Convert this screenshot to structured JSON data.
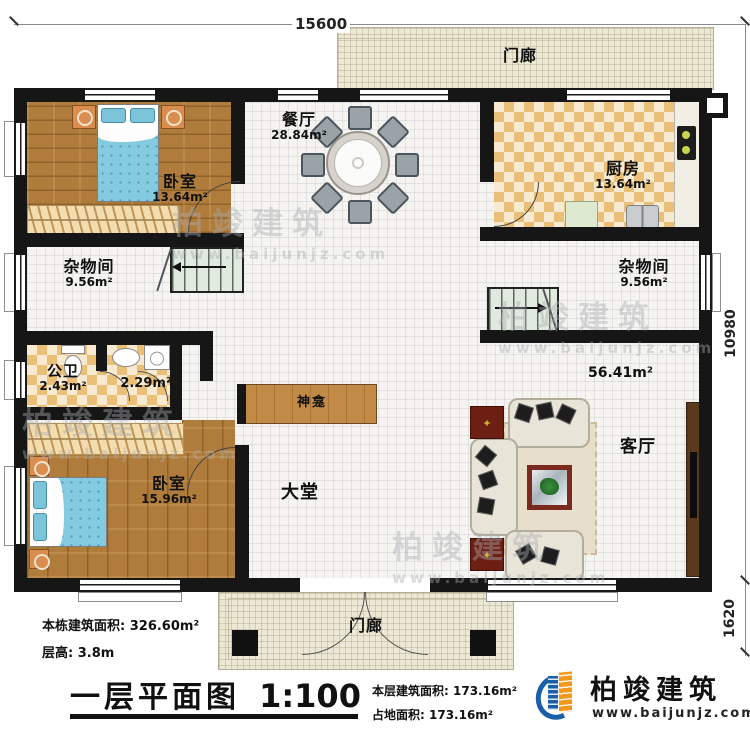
{
  "drawing": {
    "title": "一层平面图",
    "scale": "1:100"
  },
  "stats": {
    "total_area_label": "本栋建筑面积:",
    "total_area_value": "326.60m²",
    "floor_height_label": "层高:",
    "floor_height_value": "3.8m",
    "floor_area_label": "本层建筑面积:",
    "floor_area_value": "173.16m²",
    "footprint_label": "占地面积:",
    "footprint_value": "173.16m²"
  },
  "logo": {
    "company": "柏竣建筑",
    "website": "www.baijunjz.com"
  },
  "dimensions": {
    "top_width": "15600",
    "right_height": "10980",
    "right_porch": "1620"
  },
  "rooms": {
    "porch_top": {
      "name": "门廊"
    },
    "porch_bottom": {
      "name": "门廊"
    },
    "dining": {
      "name": "餐厅",
      "area": "28.84m²"
    },
    "kitchen": {
      "name": "厨房",
      "area": "13.64m²"
    },
    "bedroom_top": {
      "name": "卧室",
      "area": "13.64m²"
    },
    "storage_left": {
      "name": "杂物间",
      "area": "9.56m²"
    },
    "storage_right": {
      "name": "杂物间",
      "area": "9.56m²"
    },
    "bathroom": {
      "name": "公卫",
      "area": "2.43m²"
    },
    "bath_inner": {
      "area": "2.29m²"
    },
    "shrine": {
      "name": "神龛"
    },
    "hall": {
      "name": "大堂",
      "area": "56.41m²"
    },
    "living": {
      "name": "客厅"
    },
    "bedroom_bottom": {
      "name": "卧室",
      "area": "15.96m²"
    }
  },
  "watermark": {
    "text": "柏竣建筑",
    "url": "www.baijunjz.com"
  },
  "colors": {
    "wall": "#161616",
    "wood_floor": "#b07c3c",
    "tile_checker": "#eac078",
    "porch": "#ece8d5",
    "bed_blue": "#84cbe0",
    "stair_green": "#e1eadf",
    "accent_red": "#7a2a1e",
    "brand_blue": "#1b5fa8",
    "brand_orange": "#f2991d"
  }
}
